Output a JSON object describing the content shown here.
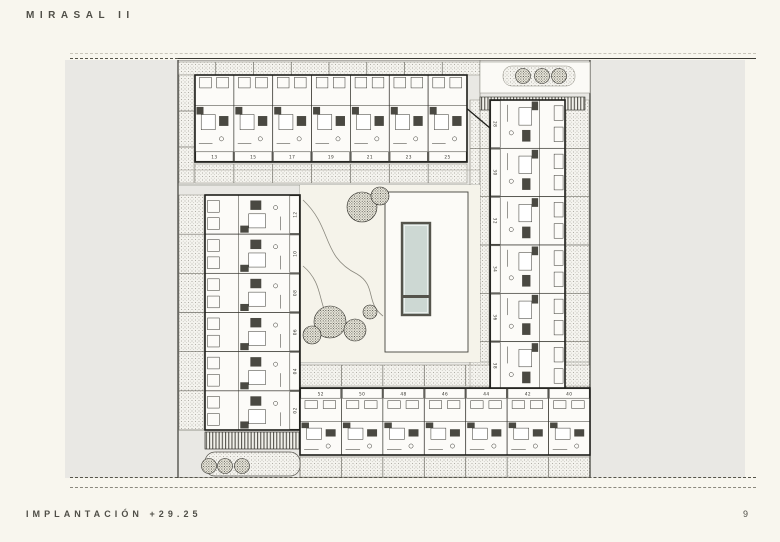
{
  "header": {
    "title": "MIRASAL II"
  },
  "footer": {
    "caption": "IMPLANTACIÓN +29.25",
    "page_number": "9"
  },
  "plan": {
    "top_row_units": [
      "13",
      "15",
      "17",
      "19",
      "21",
      "23",
      "25"
    ],
    "left_column_units": [
      "12",
      "10",
      "08",
      "06",
      "04",
      "02"
    ],
    "right_column_units": [
      "28",
      "30",
      "32",
      "34",
      "36",
      "38"
    ],
    "bottom_row_units": [
      "52",
      "50",
      "48",
      "46",
      "44",
      "42",
      "40"
    ],
    "colors": {
      "paper": "#f8f6ee",
      "sheet": "#e9e8e4",
      "ink": "#2b2a25",
      "road": "#77766d",
      "pool_water": "#cdd8d3",
      "courtyard": "#f5f3ea"
    }
  }
}
